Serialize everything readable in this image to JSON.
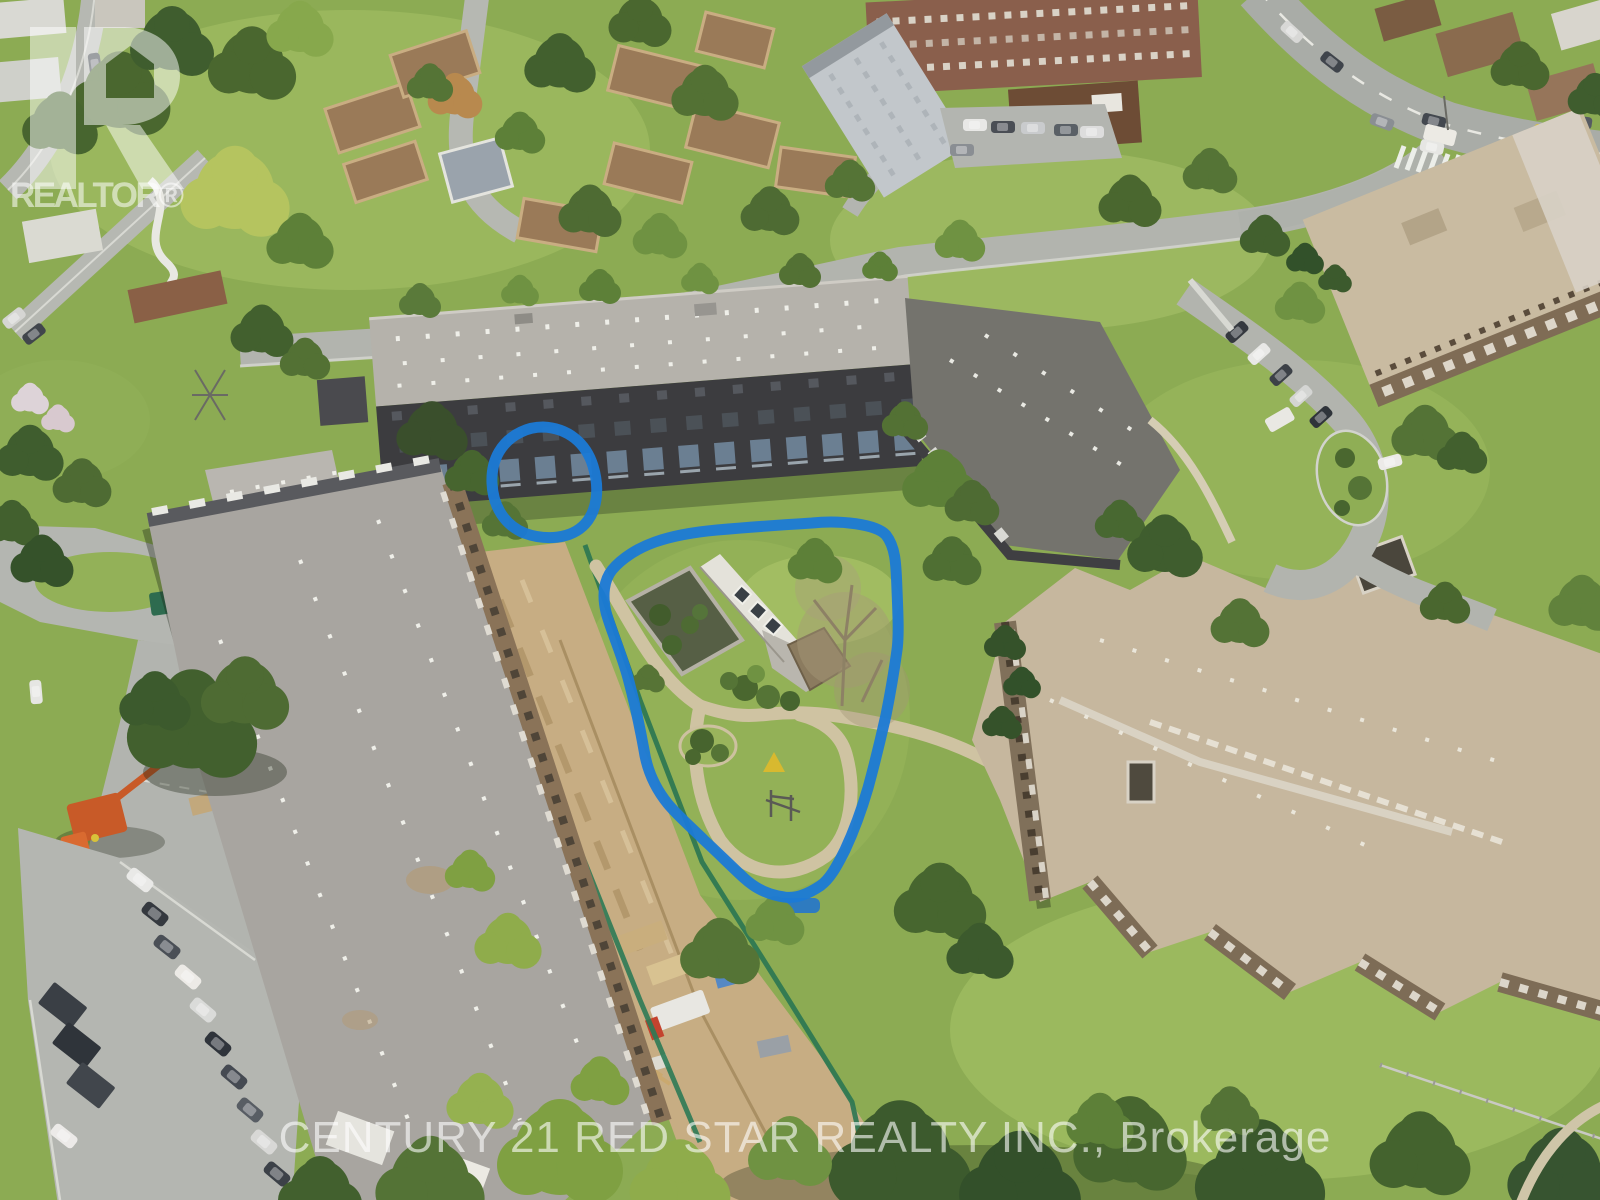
{
  "image": {
    "kind": "aerial-drone-photo",
    "subject": "condo complex with courtyard, surrounding residential neighbourhood, roads, parking lots and trees",
    "season": "spring"
  },
  "watermarks": {
    "realtor_logo_text": "REALTOR®",
    "brokerage_text": "CENTURY 21 RED STAR REALTY INC., Brokerage"
  },
  "annotations": {
    "color": "#1b7ad6",
    "items": [
      {
        "name": "small-circle",
        "description": "hand-drawn blue circle around one balcony unit of the dark condo building"
      },
      {
        "name": "large-loop",
        "description": "hand-drawn blue loop around the central courtyard green space with low building and playground"
      }
    ]
  },
  "palette": {
    "grass": "#8cab53",
    "grass_light": "#9dba60",
    "road": "#afb2ac",
    "sidewalk": "#d8d9d3",
    "central_roof": "#b5b2ab",
    "central_facade": "#3c3c3f",
    "left_roof": "#a8a5a0",
    "tan_roof": "#c6b79e",
    "brick": "#7f6c55",
    "dirt": "#c7ad83",
    "construction_fence": "#2c7a55",
    "annotation_blue": "#1b7ad6",
    "watermark_white": "#ffffff"
  }
}
